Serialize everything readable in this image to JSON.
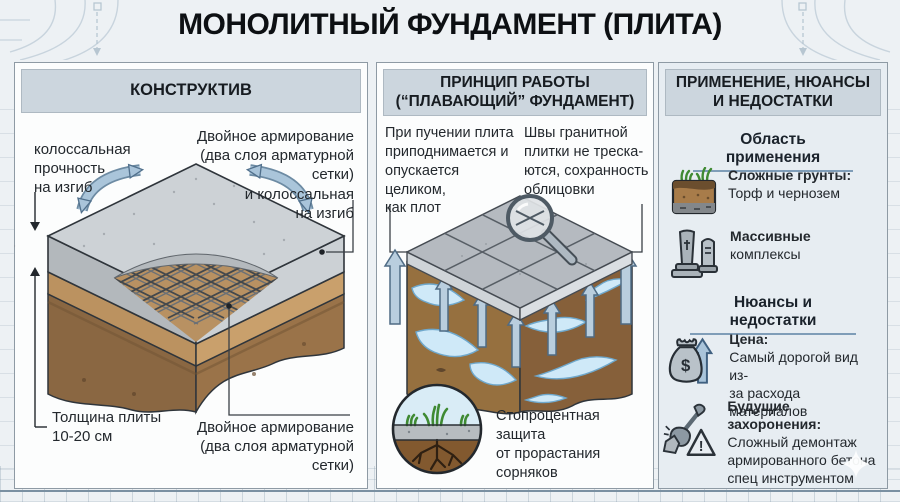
{
  "title": "МОНОЛИТНЫЙ ФУНДАМЕНТ (ПЛИТА)",
  "colors": {
    "accent_arrow_blue": "#a9c4da",
    "header_bar": "#ccd6de",
    "section_underline": "#7f9db8",
    "concrete_gray": "#cdd2d6",
    "sand_brown": "#c49a67",
    "soil_dark_brown": "#8a6742",
    "ice_blue": "#cfe9f8"
  },
  "glyphs": {
    "dollar": "$",
    "exclamation": "!"
  },
  "left_panel": {
    "header": "КОНСТРУКТИВ",
    "label_top_left": "колоссальная\nпрочность\nна изгиб",
    "label_top_right": "Двойное армирование\n(два слоя арматурной сетки)\nи колоссальная\nна изгиб",
    "label_bottom_left": "Толщина плиты\n10-20 см",
    "label_bottom_right": "Двойное армирование\n(два слоя арматурной сетки)"
  },
  "middle_panel": {
    "header": "ПРИНЦИП РАБОТЫ\n(“ПЛАВАЮЩИЙ” ФУНДАМЕНТ)",
    "text_left": "При пучении плита\nприподнимается и\nопускается целиком,\nкак плот",
    "text_right": "Швы гранитной\nплитки не треска-\nются, сохранность\nоблицовки",
    "bottom_text": "Стопроцентная защита\nот прорастания\nсорняков"
  },
  "right_panel": {
    "header": "ПРИМЕНЕНИЕ, НЮАНСЫ\nИ НЕДОСТАТКИ",
    "section_application": "Область применения",
    "section_nuances": "Нюансы и недостатки",
    "items": [
      {
        "icon": "soil-grass-icon",
        "title": "Сложные грунты:",
        "text": "Торф и чернозем"
      },
      {
        "icon": "tombstones-icon",
        "title": "Массивные",
        "text": "комплексы"
      },
      {
        "icon": "money-bag-icon",
        "title": "Цена:",
        "text": "Самый дорогой вид из-\nза расхода материалов"
      },
      {
        "icon": "shovel-warning-icon",
        "title": "Будущие захоронения:",
        "text": "Сложный демонтаж\nармированного бетона\nспец инструментом"
      }
    ]
  }
}
